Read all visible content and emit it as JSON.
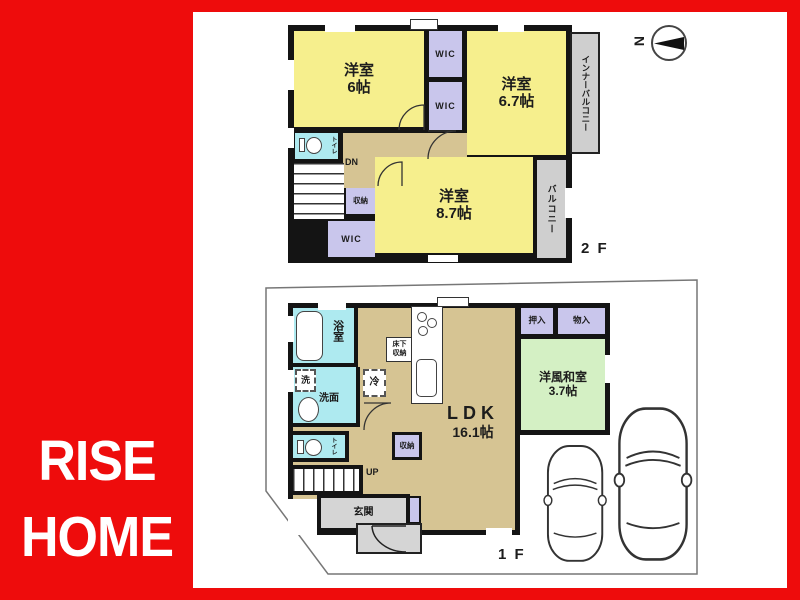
{
  "brand": {
    "line1": "RISE",
    "line2": "HOME"
  },
  "compass": {
    "north": "N"
  },
  "floor2": {
    "label": "2 F",
    "bedroom6": {
      "name": "洋室",
      "size": "6帖"
    },
    "wic_a": "WIC",
    "wic_b": "WIC",
    "wic_c": "WIC",
    "bedroom67": {
      "name": "洋室",
      "size": "6.7帖"
    },
    "inner_balcony": "インナーバルコニー",
    "balcony": "バルコニー",
    "toilet": "トイレ",
    "stairs_dn": "DN",
    "closet": "収納",
    "bedroom87": {
      "name": "洋室",
      "size": "8.7帖"
    }
  },
  "floor1": {
    "label": "1 F",
    "bath": "浴室",
    "laundry": "洗",
    "washroom": "洗面",
    "toilet": "トイレ",
    "fridge": "冷",
    "underfloor_storage": {
      "line1": "床下",
      "line2": "収納"
    },
    "stairs_up": "UP",
    "closet": "収納",
    "entrance": "玄関",
    "ldk": {
      "name": "LDK",
      "size": "16.1帖"
    },
    "oshiire": "押入",
    "monoire": "物入",
    "western_washitsu": {
      "name": "洋風和室",
      "size": "3.7帖"
    }
  },
  "colors": {
    "frame_red": "#ee0c0c",
    "room_yellow": "#f6ef8d",
    "closet_purple": "#c9c6ec",
    "water_cyan": "#aeeaf0",
    "wood_tan": "#d6c493",
    "washitsu_green": "#d4f0c4",
    "balcony_gray": "#cfcfcf",
    "wall_black": "#141414"
  }
}
